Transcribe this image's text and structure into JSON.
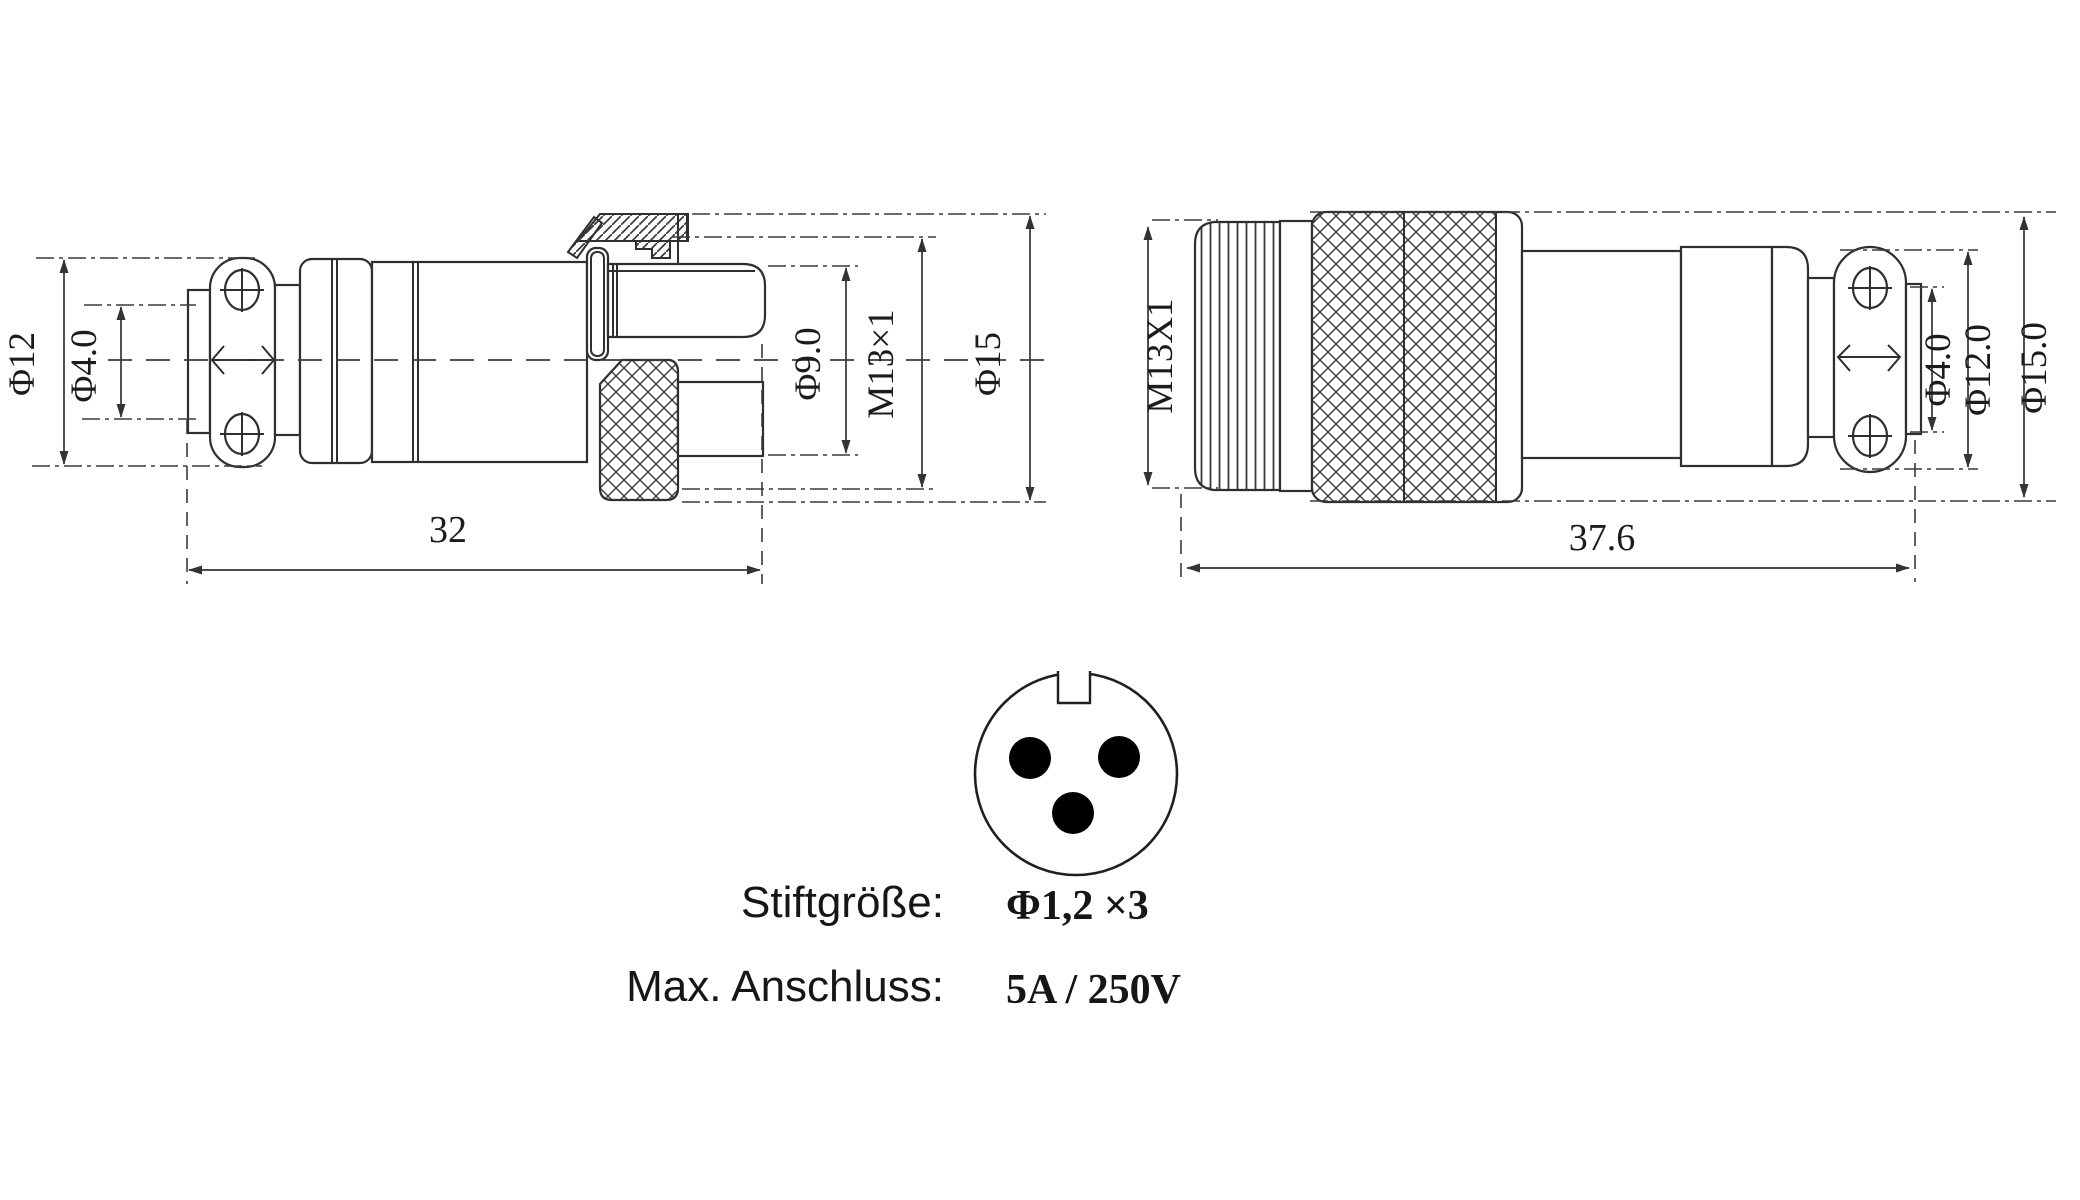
{
  "colors": {
    "background": "#ffffff",
    "line": "#2f2f2f",
    "pin_fill": "#000000"
  },
  "left_view": {
    "dim_phi12": "Φ12",
    "dim_phi4": "Φ4.0",
    "dim_phi9": "Φ9.0",
    "dim_thread": "M13×1",
    "dim_phi15": "Φ15",
    "dim_length": "32"
  },
  "right_view": {
    "dim_thread": "M13X1",
    "dim_phi4": "Φ4.0",
    "dim_phi12": "Φ12.0",
    "dim_phi15": "Φ15.0",
    "dim_length": "37.6"
  },
  "pin_face": {
    "pin_count": "3"
  },
  "specs": {
    "pin_size_label": "Stiftgröße:",
    "pin_size_value": "Φ1,2 ×3",
    "max_rating_label": "Max. Anschluss:",
    "max_rating_value": "5A / 250V"
  }
}
